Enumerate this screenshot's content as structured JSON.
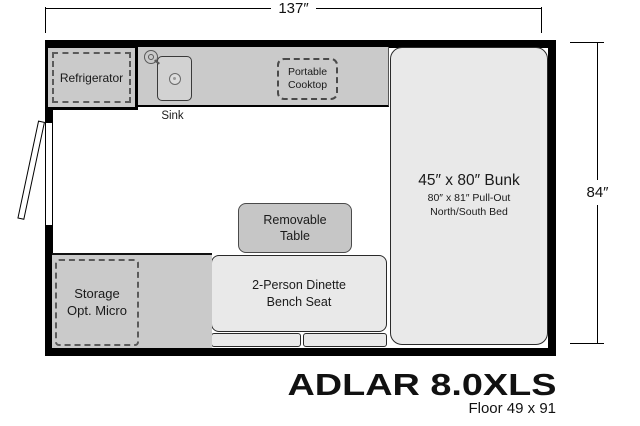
{
  "dimensions": {
    "width": "137″",
    "height": "84″"
  },
  "fixtures": {
    "refrigerator": "Refrigerator",
    "sink": "Sink",
    "cooktop": "Portable\nCooktop",
    "bunk_title": "45″ x 80″ Bunk",
    "bunk_sub1": "80″ x 81″ Pull-Out",
    "bunk_sub2": "North/South Bed",
    "table": "Removable\nTable",
    "dinette": "2-Person Dinette\nBench Seat",
    "storage": "Storage\nOpt. Micro"
  },
  "footer": {
    "model": "ADLAR 8.0XLS",
    "floor": "Floor 49 x 91"
  },
  "colors": {
    "wall": "#000000",
    "counter_fill": "#cacaca",
    "light_furniture_fill": "#e9e9e9",
    "table_fill": "#c6c6c6",
    "dashed_stroke": "#5a5a5a",
    "background": "#ffffff"
  }
}
